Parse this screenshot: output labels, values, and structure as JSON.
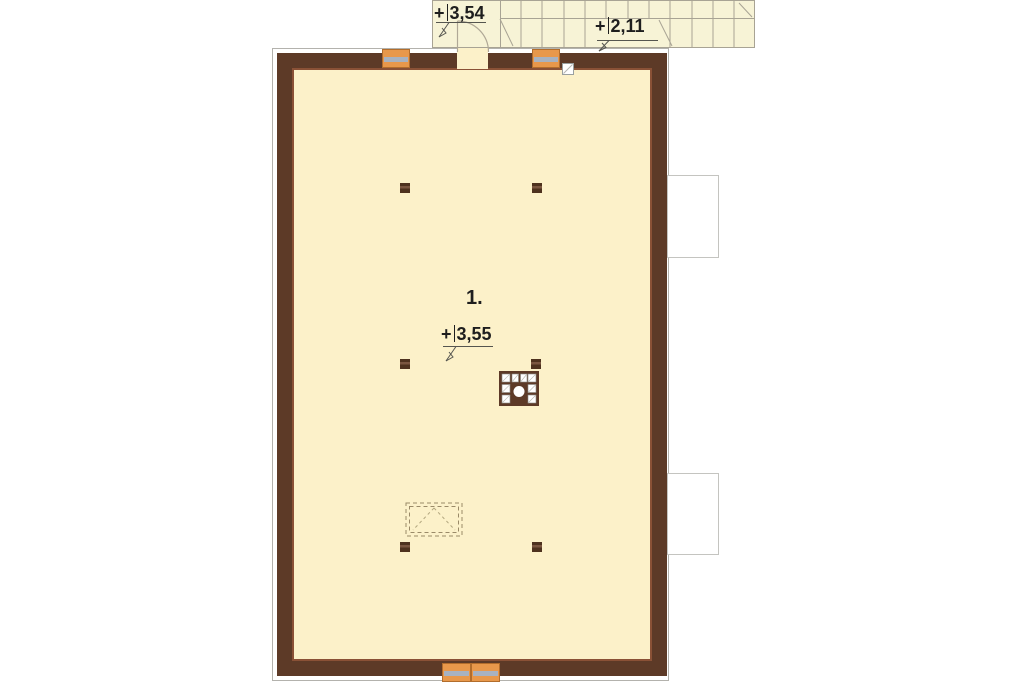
{
  "plan": {
    "room": {
      "number": "1.",
      "level": {
        "prefix": "+",
        "value": "3,55"
      }
    },
    "stairs": {
      "landing_level": {
        "prefix": "+",
        "value": "3,54"
      },
      "mid_level": {
        "prefix": "+",
        "value": "2,11"
      }
    }
  },
  "colors": {
    "room_fill": "#fcf1c9",
    "stair_fill": "#f7f3d6",
    "wall": "#5d3a27",
    "wall_light": "#8a5136",
    "window_orange": "#e8984b",
    "window_frame": "#a8b2c0",
    "outline_gray": "#b3b2ad",
    "dormer_border": "#c4c4c0",
    "post": "#4e321e",
    "stair_line": "#a8a394",
    "marker_line": "#55554f",
    "hatch_line": "#9a8a68",
    "text": "#1e1e1e"
  }
}
